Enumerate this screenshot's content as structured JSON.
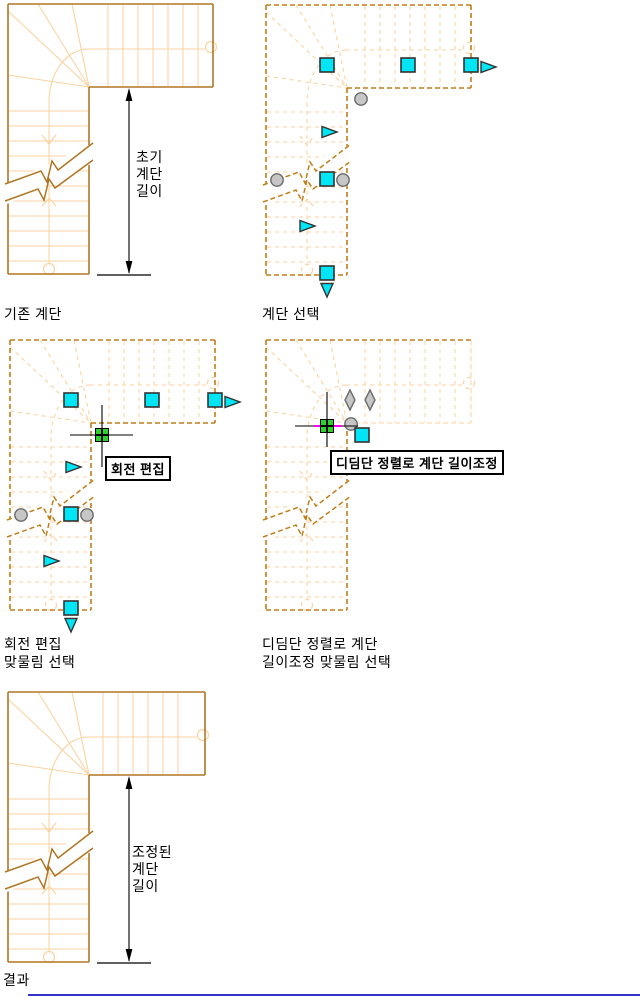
{
  "page": {
    "background": "#FFFFFF",
    "bottom_rule_color": "#3333CC"
  },
  "colors": {
    "stair_solid": "#B07623",
    "stair_dashed": "#C07D18",
    "stair_light": "#FCD3A1",
    "grip_fill": "#00E6F6",
    "grip_stroke": "#333333",
    "gray_fill": "#C6C6C6",
    "gray_stroke": "#6B6B6B",
    "hot_green": "#2ED12E",
    "magenta": "#FF00FF",
    "ink": "#000000"
  },
  "diagrams": {
    "existing": {
      "label": "기존 계단",
      "dimension_text": "초기\n계단\n길이"
    },
    "selected": {
      "label": "계단 선택"
    },
    "rotate_edit": {
      "label": "회전 편집\n맞물림 선택",
      "tooltip": "회전 편집"
    },
    "tread_align": {
      "label": "디딤단 정렬로 계단\n길이조정 맞물림 선택",
      "tooltip": "디딤단 정렬로 계단 길이조정"
    },
    "result": {
      "label": "결과",
      "dimension_text": "조정된\n계단\n길이"
    }
  },
  "grip_glyphs": {
    "square": "cyan-square-grip",
    "triangle": "cyan-arrow-grip",
    "circle": "gray-round-grip",
    "diamond": "gray-diamond-grip",
    "hot": "green-selected-grip"
  }
}
